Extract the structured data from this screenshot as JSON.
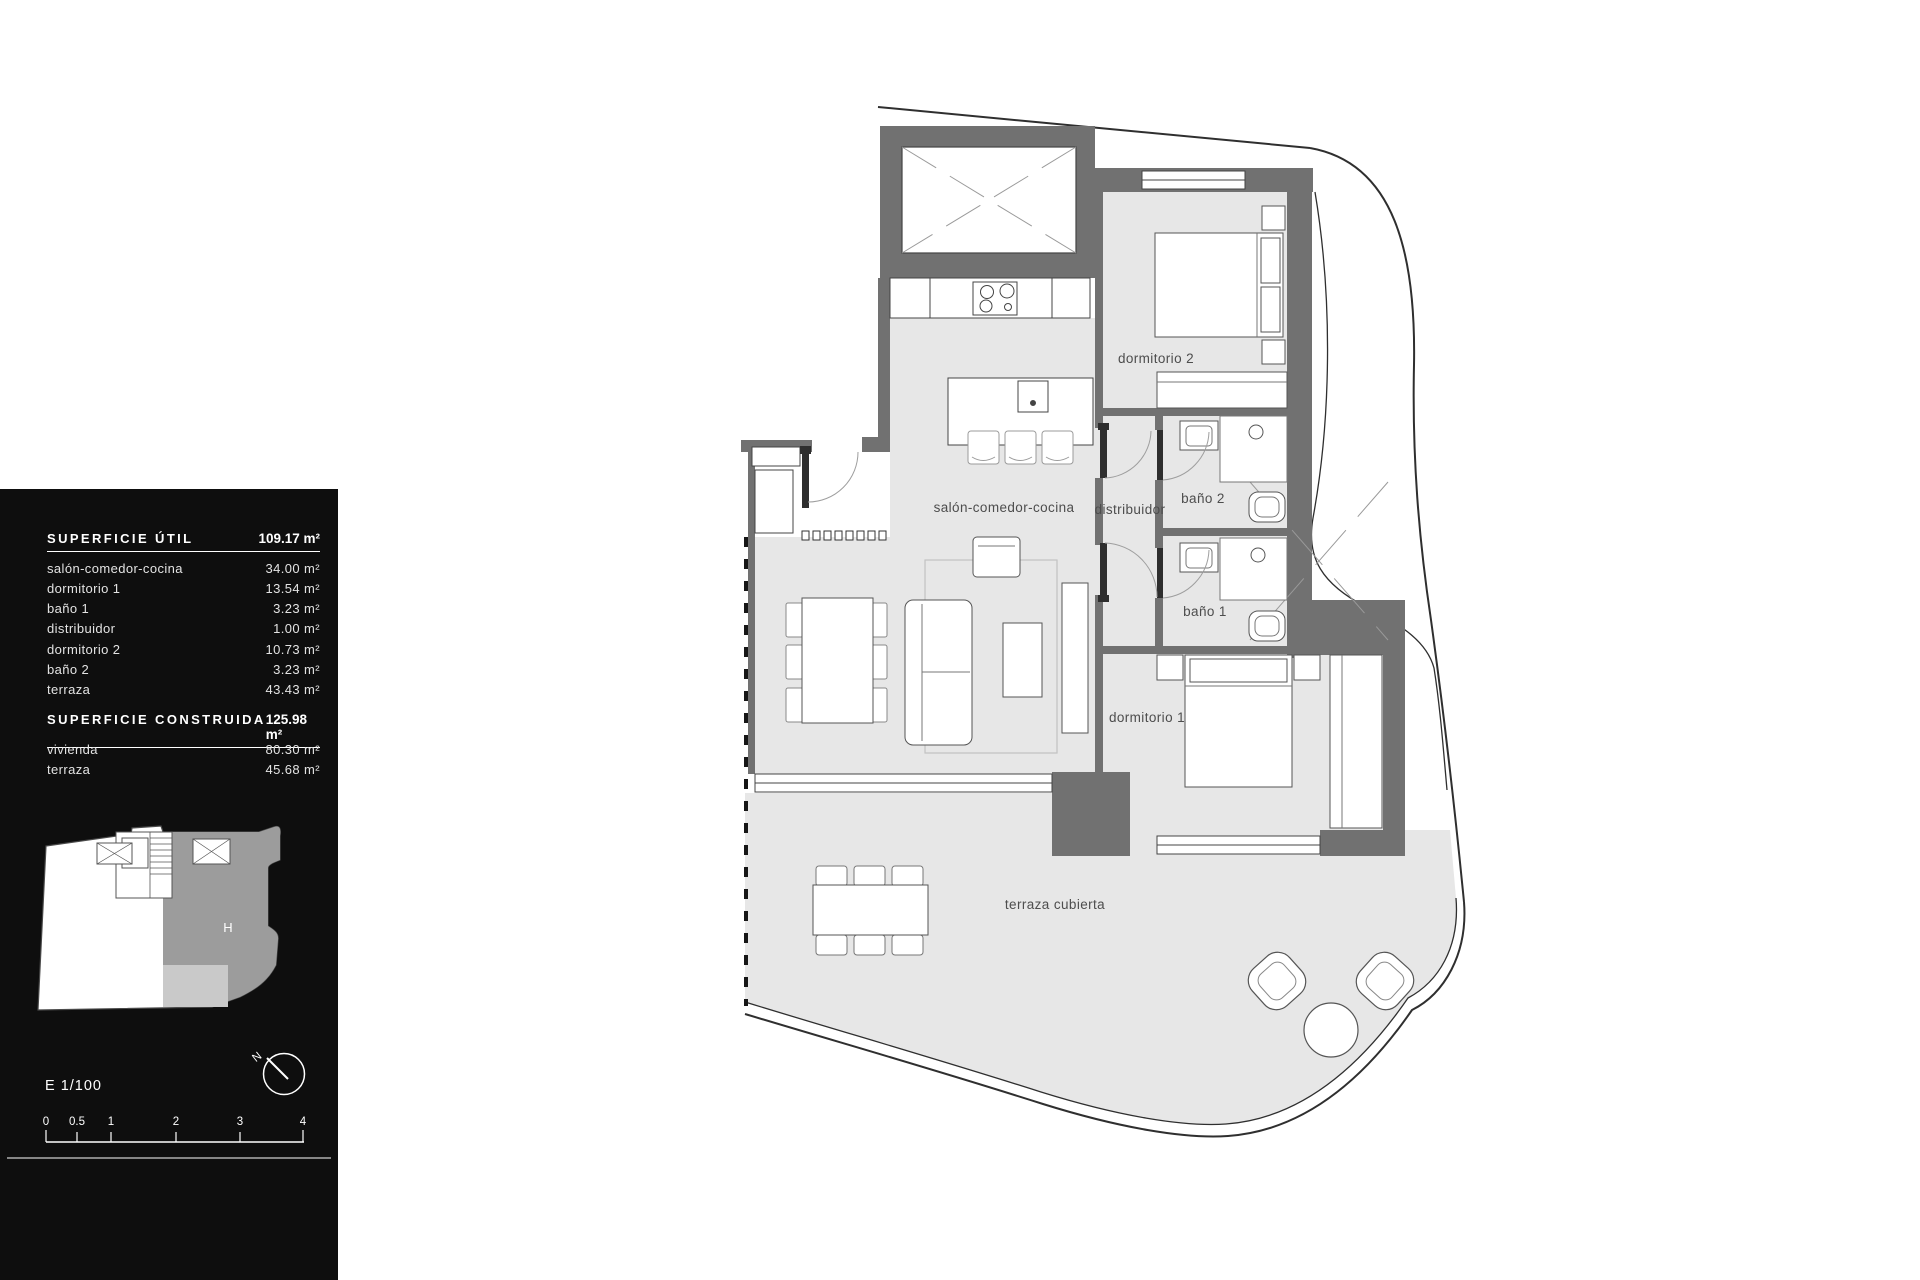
{
  "panel": {
    "superficie_util": {
      "title": "SUPERFICIE ÚTIL",
      "total": "109.17 m²",
      "rows": [
        {
          "label": "salón-comedor-cocina",
          "value": "34.00 m²"
        },
        {
          "label": "dormitorio 1",
          "value": "13.54 m²"
        },
        {
          "label": "baño 1",
          "value": "3.23 m²"
        },
        {
          "label": "distribuidor",
          "value": "1.00 m²"
        },
        {
          "label": "dormitorio 2",
          "value": "10.73 m²"
        },
        {
          "label": "baño 2",
          "value": "3.23 m²"
        },
        {
          "label": "terraza",
          "value": "43.43 m²"
        }
      ]
    },
    "superficie_construida": {
      "title": "SUPERFICIE CONSTRUIDA",
      "total": "125.98 m²",
      "rows": [
        {
          "label": "vivienda",
          "value": "80.30 m²"
        },
        {
          "label": "terraza",
          "value": "45.68 m²"
        }
      ]
    },
    "key_plan": {
      "unit_label": "H"
    },
    "scale_text": "E 1/100",
    "north_label": "N",
    "scale_bar": {
      "ticks": [
        "0",
        "0.5",
        "1",
        "2",
        "3",
        "4"
      ]
    }
  },
  "plan": {
    "labels": {
      "salon": "salón-comedor-cocina",
      "distribuidor": "distribuidor",
      "bano2": "baño 2",
      "bano1": "baño 1",
      "dormitorio2": "dormitorio 2",
      "dormitorio1": "dormitorio 1",
      "terraza": "terraza cubierta"
    }
  },
  "colors": {
    "panel_bg": "#0e0e0e",
    "wall": "#717171",
    "floor": "#e7e7e7",
    "unit_highlight": "#9c9c9c",
    "unit_terrace_highlight": "#c9c9c9",
    "boundary_line": "#2f2f2f"
  }
}
